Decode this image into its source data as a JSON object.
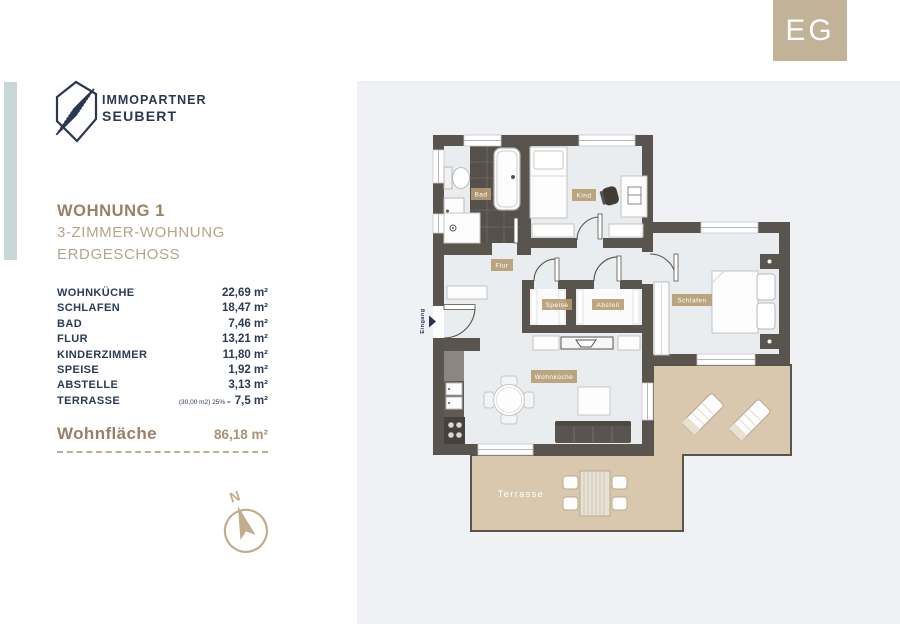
{
  "floor_badge": "EG",
  "brand": {
    "line1": "IMMOPARTNER",
    "line2": "SEUBERT"
  },
  "unit_title": {
    "name": "WOHNUNG 1",
    "type": "3-ZIMMER-WOHNUNG",
    "floor": "ERDGESCHOSS"
  },
  "area_table": {
    "rows": [
      {
        "label": "WOHNKÜCHE",
        "area": "22,69 m²"
      },
      {
        "label": "SCHLAFEN",
        "area": "18,47 m²"
      },
      {
        "label": "BAD",
        "area": "7,46 m²"
      },
      {
        "label": "FLUR",
        "area": "13,21 m²"
      },
      {
        "label": "KINDERZIMMER",
        "area": "11,80 m²"
      },
      {
        "label": "SPEISE",
        "area": "1,92 m²"
      },
      {
        "label": "ABSTELLE",
        "area": "3,13 m²"
      },
      {
        "label": "TERRASSE",
        "note": "(30,00 m2) 25% =",
        "area": "7,5 m²"
      }
    ],
    "total_label": "Wohnfläche",
    "total_area": "86,18 m²"
  },
  "compass": {
    "north": "N"
  },
  "plan": {
    "labels": {
      "bad": "Bad",
      "kind": "Kind",
      "flur": "Flur",
      "speise": "Speise",
      "abstell": "Abstell",
      "schlafen": "Schlafen",
      "wohnkueche": "Wohnküche",
      "terrasse": "Terrasse",
      "eingang": "Eingang"
    }
  },
  "colors": {
    "wall": "#59544d",
    "floor": "#e9edef",
    "tile": "#56504a",
    "terrace": "#d9c8ae",
    "navy": "#2c3652",
    "heading_brown": "#9a8164",
    "subheading_tan": "#b2a58d",
    "label_box": "#b59c72",
    "badge": "#c1b298",
    "accent_bar": "#c7d7d6",
    "panel_gray": "#eff1f4"
  }
}
